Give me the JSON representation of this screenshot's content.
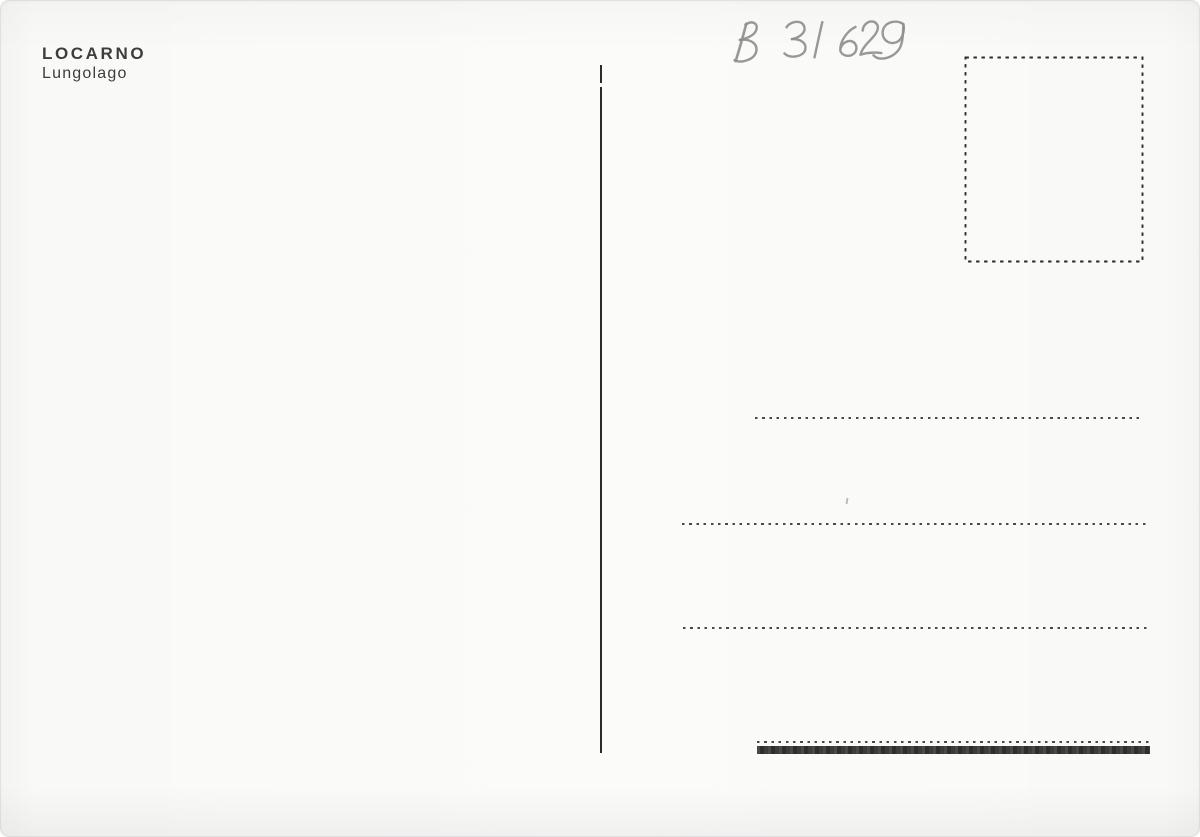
{
  "postcard": {
    "imprint": {
      "title": "LOCARNO",
      "subtitle": "Lungolago"
    },
    "handwritten_number": "B 31 629",
    "colors": {
      "paper": "#f9f9f7",
      "ink": "#3d3d3d",
      "pencil": "#8f8f8f",
      "line": "#2b2b2b",
      "bottom_bar": "#343434"
    }
  }
}
